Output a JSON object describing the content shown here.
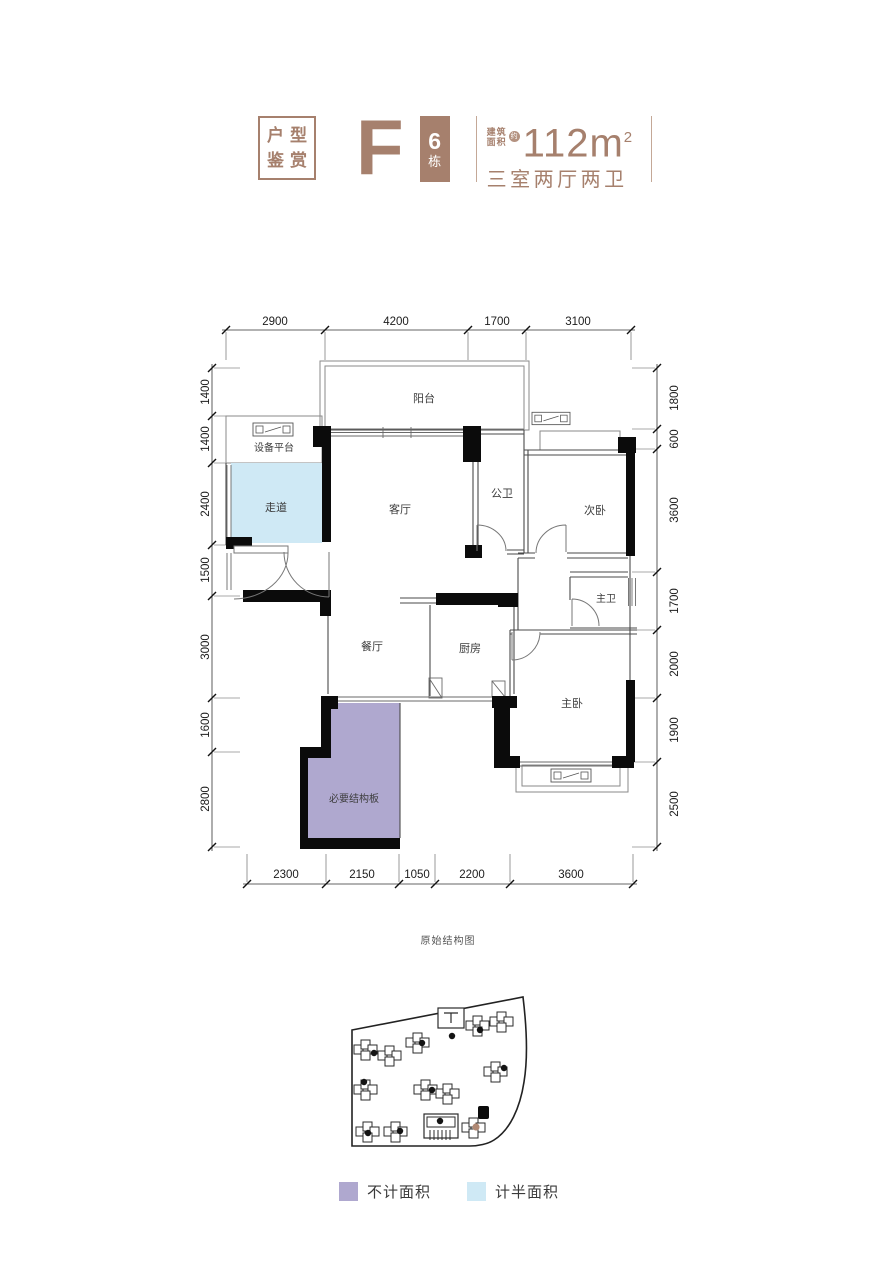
{
  "header": {
    "tag": {
      "line1": "户型",
      "line2": "鉴赏"
    },
    "unit_letter": "F",
    "building": {
      "number": "6",
      "suffix": "栋"
    },
    "area": {
      "label_line1": "建筑",
      "label_line2": "面积",
      "badge": "约",
      "value": "112m",
      "sup": "2"
    },
    "layout_desc": "三室两厅两卫",
    "accent_color": "#a6806d"
  },
  "plan": {
    "caption": "原始结构图",
    "rooms": {
      "balcony": "阳台",
      "equipment": "设备平台",
      "corridor": "走道",
      "living": "客厅",
      "public_bath": "公卫",
      "second_bed": "次卧",
      "master_bath": "主卫",
      "dining": "餐厅",
      "kitchen": "厨房",
      "master_bed": "主卧",
      "structure": "必要结构板"
    },
    "dims": {
      "top": [
        "2900",
        "4200",
        "1700",
        "3100"
      ],
      "left": [
        "1400",
        "1400",
        "2400",
        "1500",
        "3000",
        "1600",
        "2800"
      ],
      "right": [
        "1800",
        "600",
        "3600",
        "1700",
        "2000",
        "1900",
        "2500"
      ],
      "bottom": [
        "2300",
        "2150",
        "1050",
        "2200",
        "3600"
      ]
    },
    "colors": {
      "no_area": "#afa8cf",
      "half_area": "#cfe9f5",
      "wall": "#0b0b0b"
    }
  },
  "legend": {
    "items": [
      {
        "label": "不计面积",
        "color": "#afa8cf"
      },
      {
        "label": "计半面积",
        "color": "#cfe9f5"
      }
    ]
  }
}
